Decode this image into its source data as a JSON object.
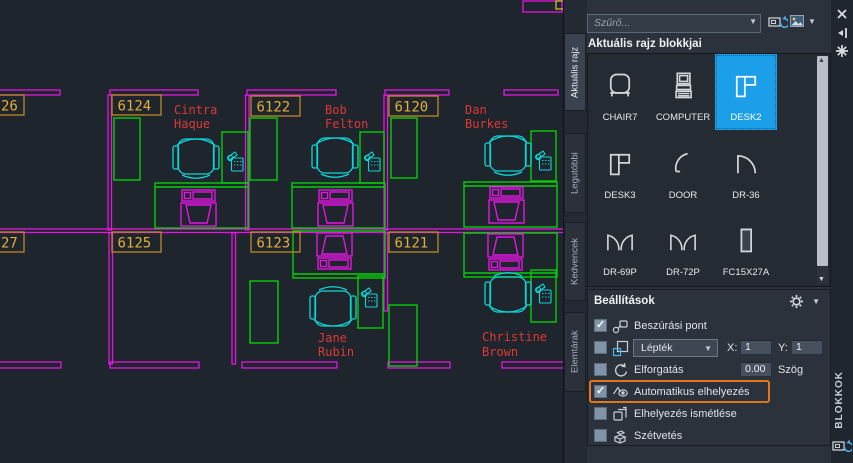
{
  "drawing": {
    "colors": {
      "background": "#1f252c",
      "walls": "#e414e4",
      "furniture": "#06ce06",
      "seating": "#0cd8d8",
      "room_labels": "#e3ae38",
      "room_label_border": "#bf8a26",
      "names": "#dc3838",
      "accent_yellow": "#cfcf20"
    },
    "rooms": [
      {
        "number": "26"
      },
      {
        "number": "6124"
      },
      {
        "number": "6122"
      },
      {
        "number": "6120"
      },
      {
        "number": "27"
      },
      {
        "number": "6125"
      },
      {
        "number": "6123"
      },
      {
        "number": "6121"
      }
    ],
    "occupants": [
      {
        "line1": "Cintra",
        "line2": "Haque"
      },
      {
        "line1": "Bob",
        "line2": "Felton"
      },
      {
        "line1": "Dan",
        "line2": "Burkes"
      },
      {
        "line1": "Jane",
        "line2": "Rubin"
      },
      {
        "line1": "Christine",
        "line2": "Brown"
      }
    ]
  },
  "palette": {
    "tabs": [
      {
        "label": "Aktuális rajz",
        "active": true
      },
      {
        "label": "Legutóbbi",
        "active": false
      },
      {
        "label": "Kedvencek",
        "active": false
      },
      {
        "label": "Elemtárak",
        "active": false
      }
    ],
    "title_vertical": "BLOKKOK",
    "search": {
      "placeholder": "Szűrő..."
    },
    "section_title": "Aktuális rajz blokkjai",
    "blocks": [
      {
        "name": "CHAIR7",
        "selected": false
      },
      {
        "name": "COMPUTER",
        "selected": false
      },
      {
        "name": "DESK2",
        "selected": true
      },
      {
        "name": "DESK3",
        "selected": false
      },
      {
        "name": "DOOR",
        "selected": false
      },
      {
        "name": "DR-36",
        "selected": false
      },
      {
        "name": "DR-69P",
        "selected": false
      },
      {
        "name": "DR-72P",
        "selected": false
      },
      {
        "name": "FC15X27A",
        "selected": false
      }
    ],
    "settings": {
      "title": "Beállítások",
      "rows": [
        {
          "label": "Beszúrási pont",
          "checked": true,
          "highlighted": false
        },
        {
          "label": "Lépték",
          "checked": false,
          "highlighted": false
        },
        {
          "label": "Elforgatás",
          "checked": false,
          "highlighted": false
        },
        {
          "label": "Automatikus elhelyezés",
          "checked": true,
          "highlighted": true
        },
        {
          "label": "Elhelyezés ismétlése",
          "checked": false,
          "highlighted": false
        },
        {
          "label": "Szétvetés",
          "checked": false,
          "highlighted": false
        }
      ],
      "scale_x_label": "X:",
      "scale_x_value": "1",
      "scale_y_label": "Y:",
      "scale_y_value": "1",
      "angle_value": "0.00",
      "angle_label": "Szög"
    },
    "accent": {
      "selection_blue": "#1b9fe8",
      "highlight_orange": "#e2761b"
    }
  }
}
